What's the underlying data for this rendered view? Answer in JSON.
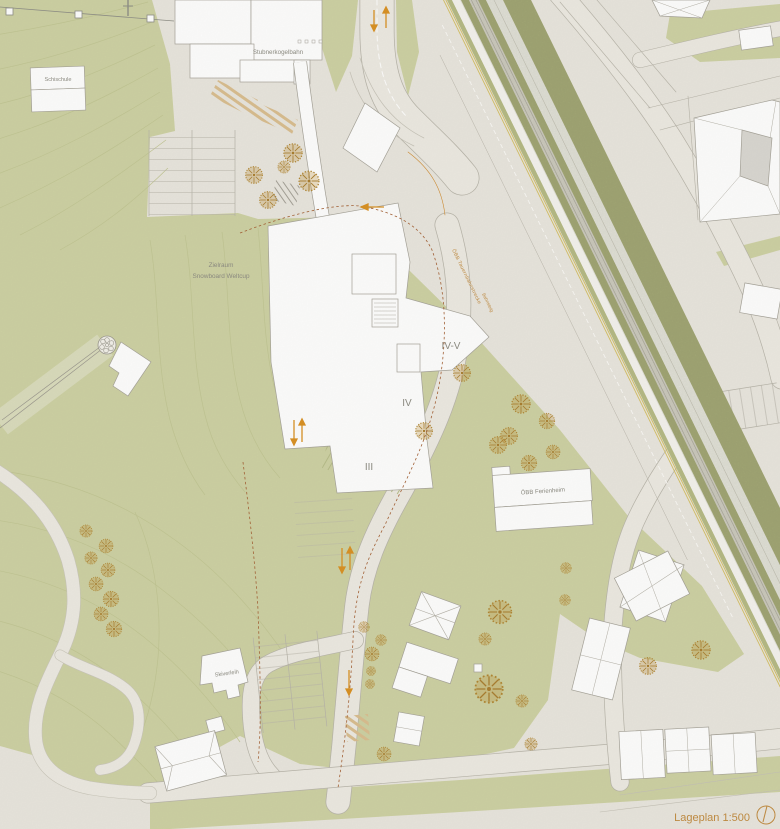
{
  "plan": {
    "labels": {
      "schischule": "Schischule",
      "stubnerkogelbahn": "Stubnerkogelbahn",
      "zielraum_line1": "Zielraum",
      "zielraum_line2": "Snowboard Weltcup",
      "railway": "ÖBB Tauernbahnstrecke",
      "bahnsteig": "Bahnsteig",
      "floor_top": "IV-V",
      "floor_mid": "IV",
      "floor_low": "III",
      "ferienheim": "ÖBB Ferienheim",
      "skiverleih": "Skiverleih",
      "caption": "Lageplan 1:500"
    },
    "palette": {
      "paper": "#e9e6de",
      "green": "#cdd1a2",
      "green_dark": "#a8ad79",
      "track": "#dad7cf",
      "road": "#edeae2",
      "building": "#ffffff",
      "outline": "#a5a298",
      "tree": "#b98d35",
      "arrow_orange": "#d98f1f",
      "boundary_red": "#a35f33",
      "label_gray": "#8b8a80",
      "label_orange": "#c08a3e"
    },
    "trees": [
      [
        293,
        153,
        12
      ],
      [
        309,
        181,
        13
      ],
      [
        254,
        175,
        11
      ],
      [
        268,
        200,
        11
      ],
      [
        284,
        167,
        8
      ],
      [
        86,
        531,
        8
      ],
      [
        106,
        546,
        9
      ],
      [
        91,
        558,
        8
      ],
      [
        108,
        570,
        9
      ],
      [
        96,
        584,
        9
      ],
      [
        111,
        599,
        10
      ],
      [
        101,
        614,
        9
      ],
      [
        114,
        629,
        10
      ],
      [
        462,
        373,
        11
      ],
      [
        424,
        431,
        11
      ],
      [
        521,
        404,
        12
      ],
      [
        547,
        421,
        10
      ],
      [
        509,
        436,
        11
      ],
      [
        553,
        452,
        9
      ],
      [
        529,
        463,
        10
      ],
      [
        498,
        445,
        11
      ],
      [
        381,
        640,
        7
      ],
      [
        372,
        654,
        9
      ],
      [
        371,
        671,
        6
      ],
      [
        370,
        684,
        6
      ],
      [
        500,
        612,
        15
      ],
      [
        485,
        639,
        8
      ],
      [
        489,
        689,
        18
      ],
      [
        522,
        701,
        8
      ],
      [
        531,
        744,
        8
      ],
      [
        384,
        754,
        9
      ],
      [
        364,
        627,
        7
      ],
      [
        566,
        568,
        7
      ],
      [
        565,
        600,
        7
      ],
      [
        648,
        666,
        11
      ],
      [
        701,
        650,
        12
      ]
    ]
  }
}
